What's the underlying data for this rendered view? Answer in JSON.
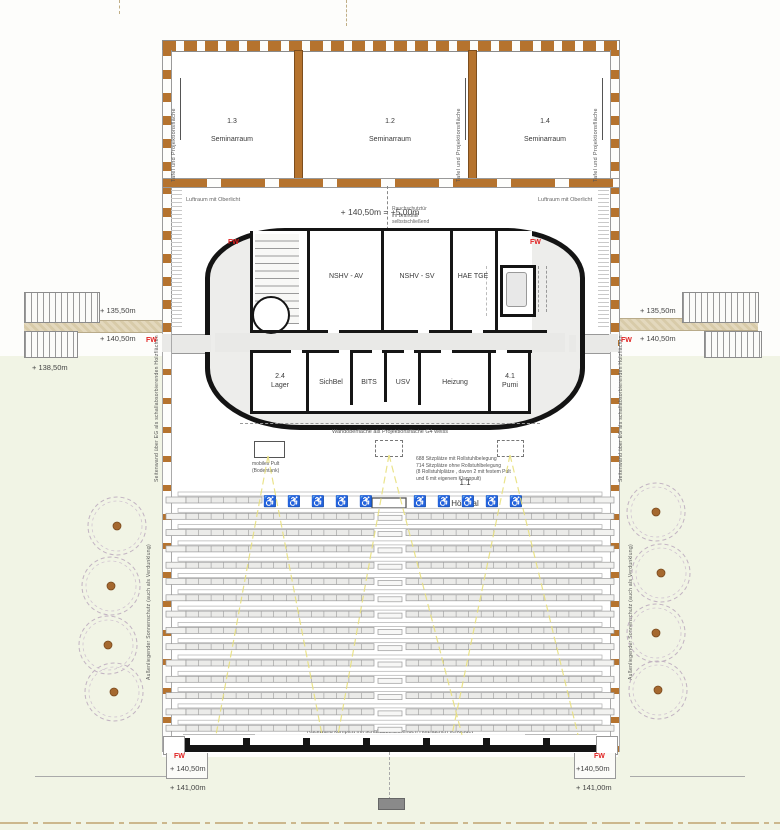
{
  "seminar": {
    "rooms": [
      {
        "id": "1.3",
        "name": "Seminarraum"
      },
      {
        "id": "1.2",
        "name": "Seminarraum"
      },
      {
        "id": "1.4",
        "name": "Seminarraum"
      }
    ],
    "board_note": "Tafel und Projektionsfläche"
  },
  "voids": {
    "left": "Luftraum mit Oberlicht",
    "right": "Luftraum mit Oberlicht"
  },
  "levels": {
    "main": "+ 140,50m = +5,00m",
    "left_upper": "+ 135,50m",
    "left_mid": "+ 140,50m",
    "left_lower": "+ 138,50m",
    "right_upper": "+ 135,50m",
    "right_mid": "+ 140,50m",
    "bottom_left_1": "+ 140,50m",
    "bottom_left_2": "+ 141,00m",
    "bottom_right_1": "+140,50m",
    "bottom_right_2": "+ 141,00m"
  },
  "fire": {
    "label": "FW"
  },
  "smoke_door_note": "Rauchschutztür\nim Brandfall\nselbstschließend",
  "core": {
    "upper_rooms": [
      {
        "name": "NSHV - AV"
      },
      {
        "name": "NSHV - SV"
      },
      {
        "name": "HAE TGE"
      }
    ],
    "lower_rooms": [
      {
        "name": "2.4\nLager"
      },
      {
        "name": "SichBel"
      },
      {
        "name": "BITS"
      },
      {
        "name": "USV"
      },
      {
        "name": "Heizung"
      },
      {
        "name": "4.1\nPumi"
      }
    ]
  },
  "projection_note": "Wandoberfläche  als Projektionsfläche   G4 weiss",
  "hall": {
    "id": "1.1",
    "name": "Hörsaal"
  },
  "pult_note": "mobiles Pult\n(Bodentank)",
  "seat_note": "688 Sitzplätze mit Rollstuhlbelegung\n714 Sitzplätze ohne Rollstuhlbelegung\n(8 Rollstuhlplätze , davon 2 mit festem Pult\nund 6 mit eigenem Klapppult)",
  "rear_wall_note": "Rückwand komplett mit schallabsorbierenden  Holzflächen  verkleidet",
  "side_wall_note": "Seitenwand über EG als schallabsorbierenden  Holzflächen",
  "sun_note": "Außenliegender  Sonnenschutz  (auch als Verdunklung)",
  "colors": {
    "wood": "#b5732e",
    "wall": "#161616",
    "floor": "#e9e9e7",
    "lawn": "#f1f4e5",
    "accent_red": "#e02020",
    "sight_line": "#e8e07e",
    "walkway": "#e0d5b8",
    "tree_stroke": "#c2b3c2",
    "tree_dot": "#a5682f"
  },
  "seating": {
    "rows": 15,
    "seats_per_half": 15,
    "wheelchair_icon": "♿",
    "wheelchairs_left": 5,
    "wheelchairs_right": 5
  }
}
